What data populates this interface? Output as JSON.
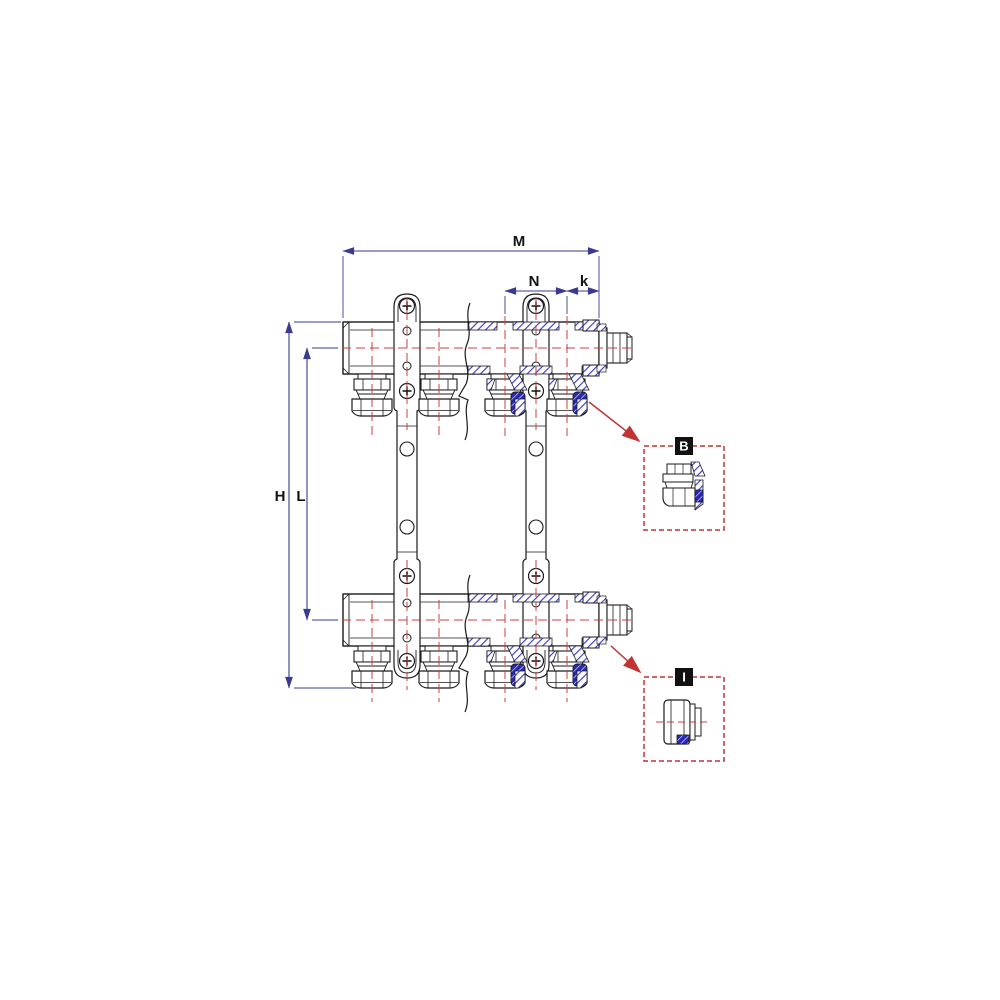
{
  "drawing": {
    "type": "manifold-technical-drawing",
    "dimensions": {
      "m": "M",
      "n": "N",
      "k": "k",
      "h": "H",
      "l": "L"
    },
    "details": {
      "b": "B",
      "i": "I"
    },
    "colors": {
      "outline": "#1b1b1b",
      "section_hatch_blue": "#3c3cc8",
      "section_accent_blue": "#2828b4",
      "centerline_red": "#c84040",
      "dimension_navy": "#3a3a90",
      "callout_red": "#c23434",
      "label_background": "#111111",
      "label_text": "#ffffff",
      "background": "#ffffff"
    }
  }
}
